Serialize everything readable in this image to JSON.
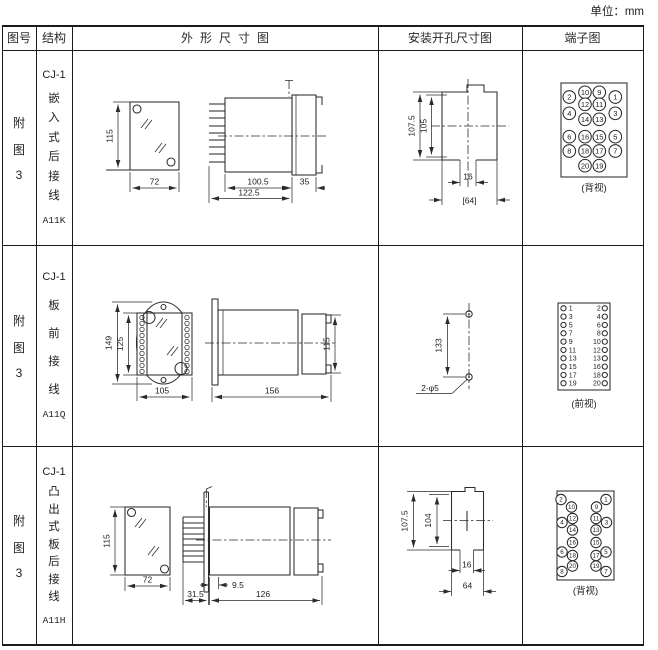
{
  "unit_label": "单位：mm",
  "header": {
    "figure_no": "图号",
    "structure": "结构",
    "outline": "外形尺寸图",
    "mounting": "安装开孔尺寸图",
    "terminal": "端子图"
  },
  "rows": [
    {
      "figure_no": [
        "附",
        "图",
        "3"
      ],
      "series": "CJ-1",
      "structure_chars": [
        "嵌",
        "入",
        "式",
        "后",
        "接",
        "线"
      ],
      "model": "A11K",
      "outline_dims": {
        "height": "115",
        "width": "72",
        "body_length": "100.5",
        "total_length": "122.5",
        "flange_depth": "35"
      },
      "mounting_dims": {
        "outer_height": "107.5",
        "inner_height": "105",
        "slot_width": "16",
        "total_width": "[64]"
      },
      "terminal": {
        "view_label": "(背视)",
        "circles": [
          "2",
          "10",
          "9",
          "1",
          "4",
          "12",
          "11",
          "3",
          "14",
          "13",
          "6",
          "16",
          "15",
          "5",
          "8",
          "18",
          "17",
          "7",
          "20",
          "19"
        ]
      }
    },
    {
      "figure_no": [
        "附",
        "图",
        "3"
      ],
      "series": "CJ-1",
      "structure_chars": [
        "板",
        "前",
        "接",
        "线"
      ],
      "model": "A11Q",
      "outline_dims": {
        "flange_height": "149",
        "body_height": "125",
        "width": "105",
        "length": "156",
        "side_height": "115"
      },
      "mounting_dims": {
        "hole_spacing": "133",
        "holes": "2-φ5"
      },
      "terminal": {
        "view_label": "(前视)",
        "left_column": [
          "1",
          "3",
          "5",
          "7",
          "9",
          "11",
          "13",
          "15",
          "17",
          "19"
        ],
        "right_column": [
          "2",
          "4",
          "6",
          "8",
          "10",
          "12",
          "13",
          "16",
          "18",
          "20"
        ]
      }
    },
    {
      "figure_no": [
        "附",
        "图",
        "3"
      ],
      "series": "CJ-1",
      "structure_chars": [
        "凸",
        "出",
        "式",
        "板",
        "后",
        "接",
        "线"
      ],
      "model": "A11H",
      "outline_dims": {
        "height": "115",
        "width": "72",
        "pin_depth": "31.5",
        "offset": "9.5",
        "body_length": "126"
      },
      "mounting_dims": {
        "outer_height": "107.5",
        "inner_height": "104",
        "slot_width": "16",
        "total_width": "64"
      },
      "terminal": {
        "view_label": "(背视)",
        "circles": [
          "2",
          "1",
          "10",
          "9",
          "4",
          "12",
          "11",
          "3",
          "14",
          "13",
          "16",
          "15",
          "6",
          "18",
          "17",
          "5",
          "20",
          "19",
          "8",
          "7"
        ]
      }
    }
  ]
}
